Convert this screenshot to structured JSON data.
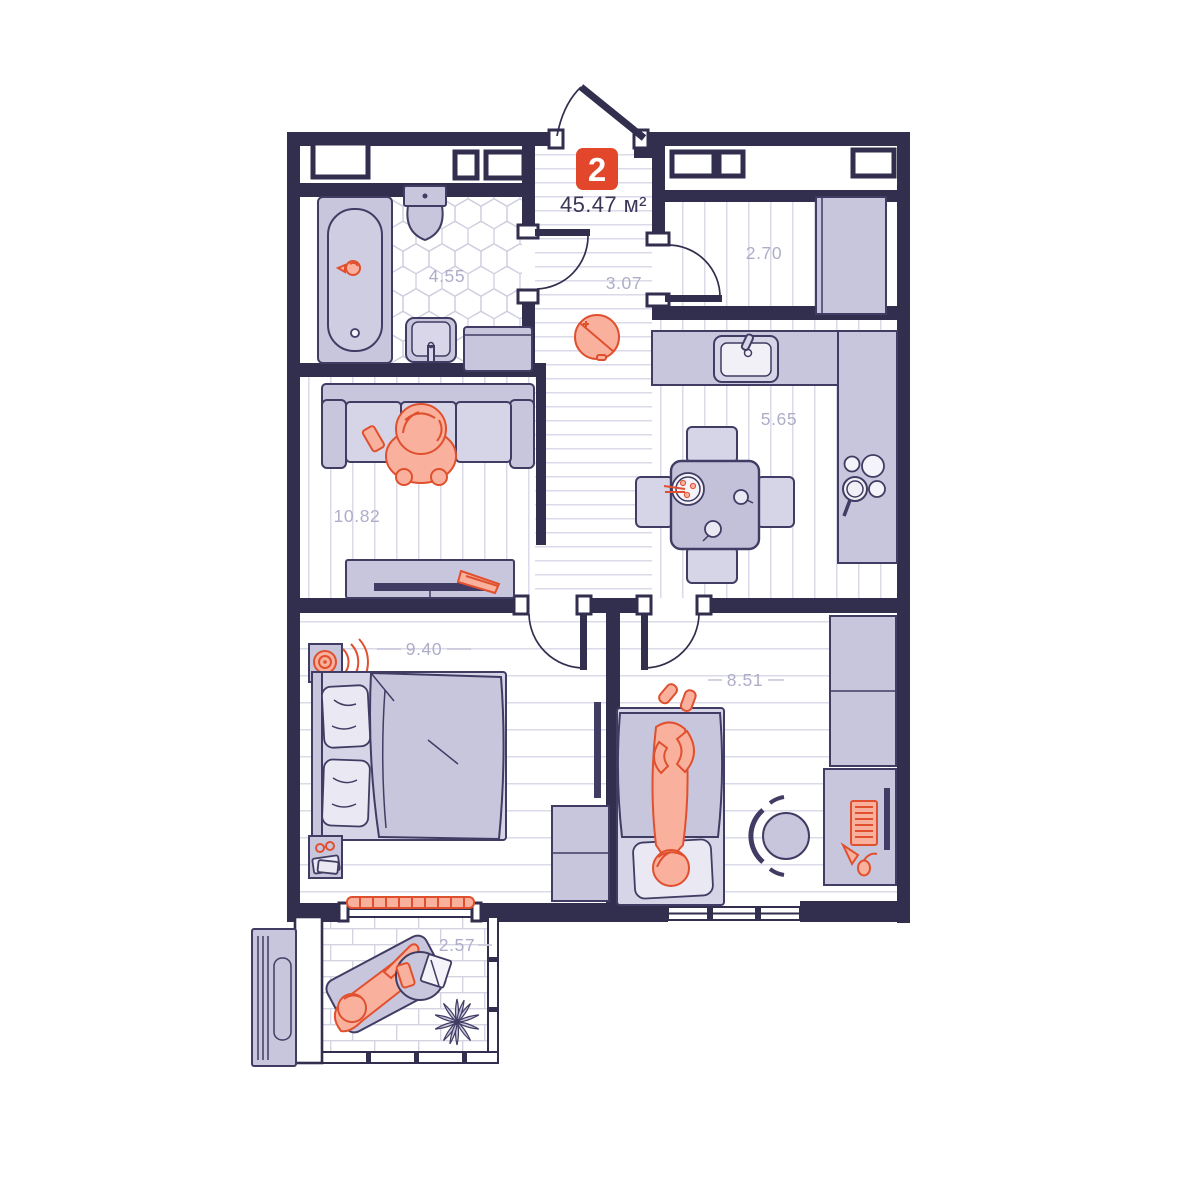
{
  "title": {
    "badge_number": "2",
    "total_area": "45.47 м²"
  },
  "rooms": {
    "bathroom": {
      "name": "bathroom",
      "area": "4.55"
    },
    "hallway": {
      "name": "hallway",
      "area": "3.07"
    },
    "storage": {
      "name": "storage",
      "area": "2.70"
    },
    "kitchen": {
      "name": "kitchen",
      "area": "5.65"
    },
    "living_room": {
      "name": "living-room",
      "area": "10.82"
    },
    "bedroom_main": {
      "name": "bedroom-main",
      "area": "9.40"
    },
    "bedroom_second": {
      "name": "bedroom-second",
      "area": "8.51"
    },
    "balcony": {
      "name": "balcony",
      "area": "2.57"
    }
  },
  "colors": {
    "wall": "#322E4D",
    "accent": "#E2472B",
    "furn": "#C8C6DD",
    "furn-light": "#D6D4E7",
    "furn-pale": "#E9E8F3",
    "outline": "#413C63",
    "orange": "#F9B19D",
    "orange-stroke": "#E0502F",
    "label": "#AEADC8",
    "floor-line": "#DBDAE8",
    "title-text": "#3A3655"
  }
}
